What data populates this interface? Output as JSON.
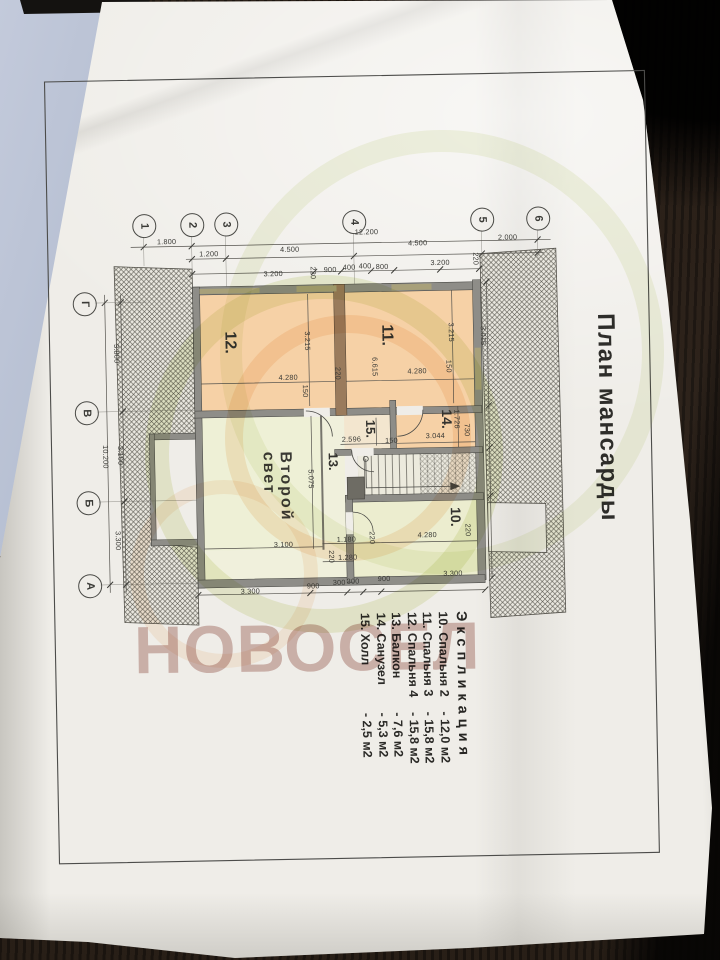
{
  "title": "План мансарды",
  "brand_watermark": "НОВОСЕЛ",
  "second_light": {
    "line1": "Второй",
    "line2": "свет"
  },
  "explication": {
    "header": "Экспликация",
    "items": [
      {
        "num": "10.",
        "name": "Спальня 2",
        "area": "12,0 м2"
      },
      {
        "num": "11.",
        "name": "Спальня 3",
        "area": "15,8 м2"
      },
      {
        "num": "12.",
        "name": "Спальня 4",
        "area": "15,8 м2"
      },
      {
        "num": "13.",
        "name": "Балкон",
        "area": "7,6 м2"
      },
      {
        "num": "14.",
        "name": "Санузел",
        "area": "5,3 м2"
      },
      {
        "num": "15.",
        "name": "Холл",
        "area": "2,5 м2"
      }
    ]
  },
  "axes_top": {
    "cy": 221,
    "items": [
      {
        "label": "1",
        "cx": 148
      },
      {
        "label": "2",
        "cx": 196
      },
      {
        "label": "3",
        "cx": 230
      },
      {
        "label": "4",
        "cx": 358
      },
      {
        "label": "5",
        "cx": 486
      },
      {
        "label": "6",
        "cx": 542
      }
    ]
  },
  "axes_left": {
    "cx": 87,
    "items": [
      {
        "label": "Г",
        "cy": 298
      },
      {
        "label": "В",
        "cy": 407
      },
      {
        "label": "Б",
        "cy": 497
      },
      {
        "label": "А",
        "cy": 580
      }
    ]
  },
  "room_labels": [
    {
      "t": "12.",
      "x": 241,
      "y": 329,
      "s": 16
    },
    {
      "t": "11.",
      "x": 398,
      "y": 325,
      "s": 16
    },
    {
      "t": "14.",
      "x": 456,
      "y": 411,
      "s": 14
    },
    {
      "t": "15.",
      "x": 379,
      "y": 420,
      "s": 13
    },
    {
      "t": "13.",
      "x": 341,
      "y": 452,
      "s": 13
    },
    {
      "t": "10.",
      "x": 463,
      "y": 509,
      "s": 14
    }
  ],
  "dim_labels": [
    {
      "t": "1.800",
      "x": 171,
      "y": 238,
      "v": 0
    },
    {
      "t": "12.200",
      "x": 371,
      "y": 232,
      "v": 0
    },
    {
      "t": "1.200",
      "x": 213,
      "y": 251,
      "v": 0
    },
    {
      "t": "4.500",
      "x": 294,
      "y": 248,
      "v": 0
    },
    {
      "t": "4.500",
      "x": 422,
      "y": 244,
      "v": 0
    },
    {
      "t": "2.000",
      "x": 512,
      "y": 240,
      "v": 0
    },
    {
      "t": "3.200",
      "x": 277,
      "y": 272,
      "v": 0
    },
    {
      "t": "220",
      "x": 317,
      "y": 272,
      "v": 1
    },
    {
      "t": "900",
      "x": 334,
      "y": 269,
      "v": 0
    },
    {
      "t": "400",
      "x": 353,
      "y": 267,
      "v": 0
    },
    {
      "t": "400",
      "x": 369,
      "y": 266,
      "v": 0
    },
    {
      "t": "800",
      "x": 386,
      "y": 267,
      "v": 0
    },
    {
      "t": "3.200",
      "x": 444,
      "y": 264,
      "v": 0
    },
    {
      "t": "220",
      "x": 480,
      "y": 261,
      "v": 1
    },
    {
      "t": "3.800",
      "x": 119,
      "y": 349,
      "v": 1
    },
    {
      "t": "10.200",
      "x": 106,
      "y": 452,
      "v": 1
    },
    {
      "t": "3.100",
      "x": 121,
      "y": 451,
      "v": 1
    },
    {
      "t": "3.300",
      "x": 117,
      "y": 536,
      "v": 1
    },
    {
      "t": "3.215",
      "x": 310,
      "y": 340,
      "v": 1
    },
    {
      "t": "3.215",
      "x": 454,
      "y": 334,
      "v": 1
    },
    {
      "t": "3.015",
      "x": 486,
      "y": 338,
      "v": 1
    },
    {
      "t": "6.615",
      "x": 377,
      "y": 367,
      "v": 1
    },
    {
      "t": "4.280",
      "x": 290,
      "y": 376,
      "v": 0
    },
    {
      "t": "220",
      "x": 340,
      "y": 373,
      "v": 1
    },
    {
      "t": "4.280",
      "x": 419,
      "y": 372,
      "v": 0
    },
    {
      "t": "150",
      "x": 307,
      "y": 390,
      "v": 1
    },
    {
      "t": "150",
      "x": 451,
      "y": 368,
      "v": 1
    },
    {
      "t": "2.596",
      "x": 352,
      "y": 439,
      "v": 0
    },
    {
      "t": "150",
      "x": 392,
      "y": 441,
      "v": 0
    },
    {
      "t": "1.726",
      "x": 458,
      "y": 421,
      "v": 1
    },
    {
      "t": "3.044",
      "x": 436,
      "y": 437,
      "v": 0
    },
    {
      "t": "730",
      "x": 468,
      "y": 432,
      "v": 1
    },
    {
      "t": "5.075",
      "x": 311,
      "y": 478,
      "v": 1
    },
    {
      "t": "3.100",
      "x": 282,
      "y": 543,
      "v": 0
    },
    {
      "t": "1.180",
      "x": 345,
      "y": 539,
      "v": 0
    },
    {
      "t": "220",
      "x": 371,
      "y": 538,
      "v": 1
    },
    {
      "t": "4.280",
      "x": 426,
      "y": 536,
      "v": 0
    },
    {
      "t": "220",
      "x": 467,
      "y": 532,
      "v": 1
    },
    {
      "t": "1.280",
      "x": 346,
      "y": 557,
      "v": 0
    },
    {
      "t": "220",
      "x": 330,
      "y": 556,
      "v": 1
    },
    {
      "t": "3.300",
      "x": 248,
      "y": 589,
      "v": 0
    },
    {
      "t": "900",
      "x": 311,
      "y": 585,
      "v": 0
    },
    {
      "t": "300",
      "x": 337,
      "y": 582,
      "v": 0
    },
    {
      "t": "300",
      "x": 351,
      "y": 581,
      "v": 0
    },
    {
      "t": "900",
      "x": 382,
      "y": 579,
      "v": 0
    },
    {
      "t": "3.300",
      "x": 451,
      "y": 575,
      "v": 0
    }
  ],
  "colors": {
    "paper": "#efede8",
    "peach": "#f6d1a6",
    "pale_green": "#eef0d6",
    "wall": "#8e8d88",
    "wall_brown": "#9a7b5c",
    "watermark_pink": "#b07972",
    "ring_green": "#cdd98e",
    "ring_orange": "#f0c08a"
  }
}
